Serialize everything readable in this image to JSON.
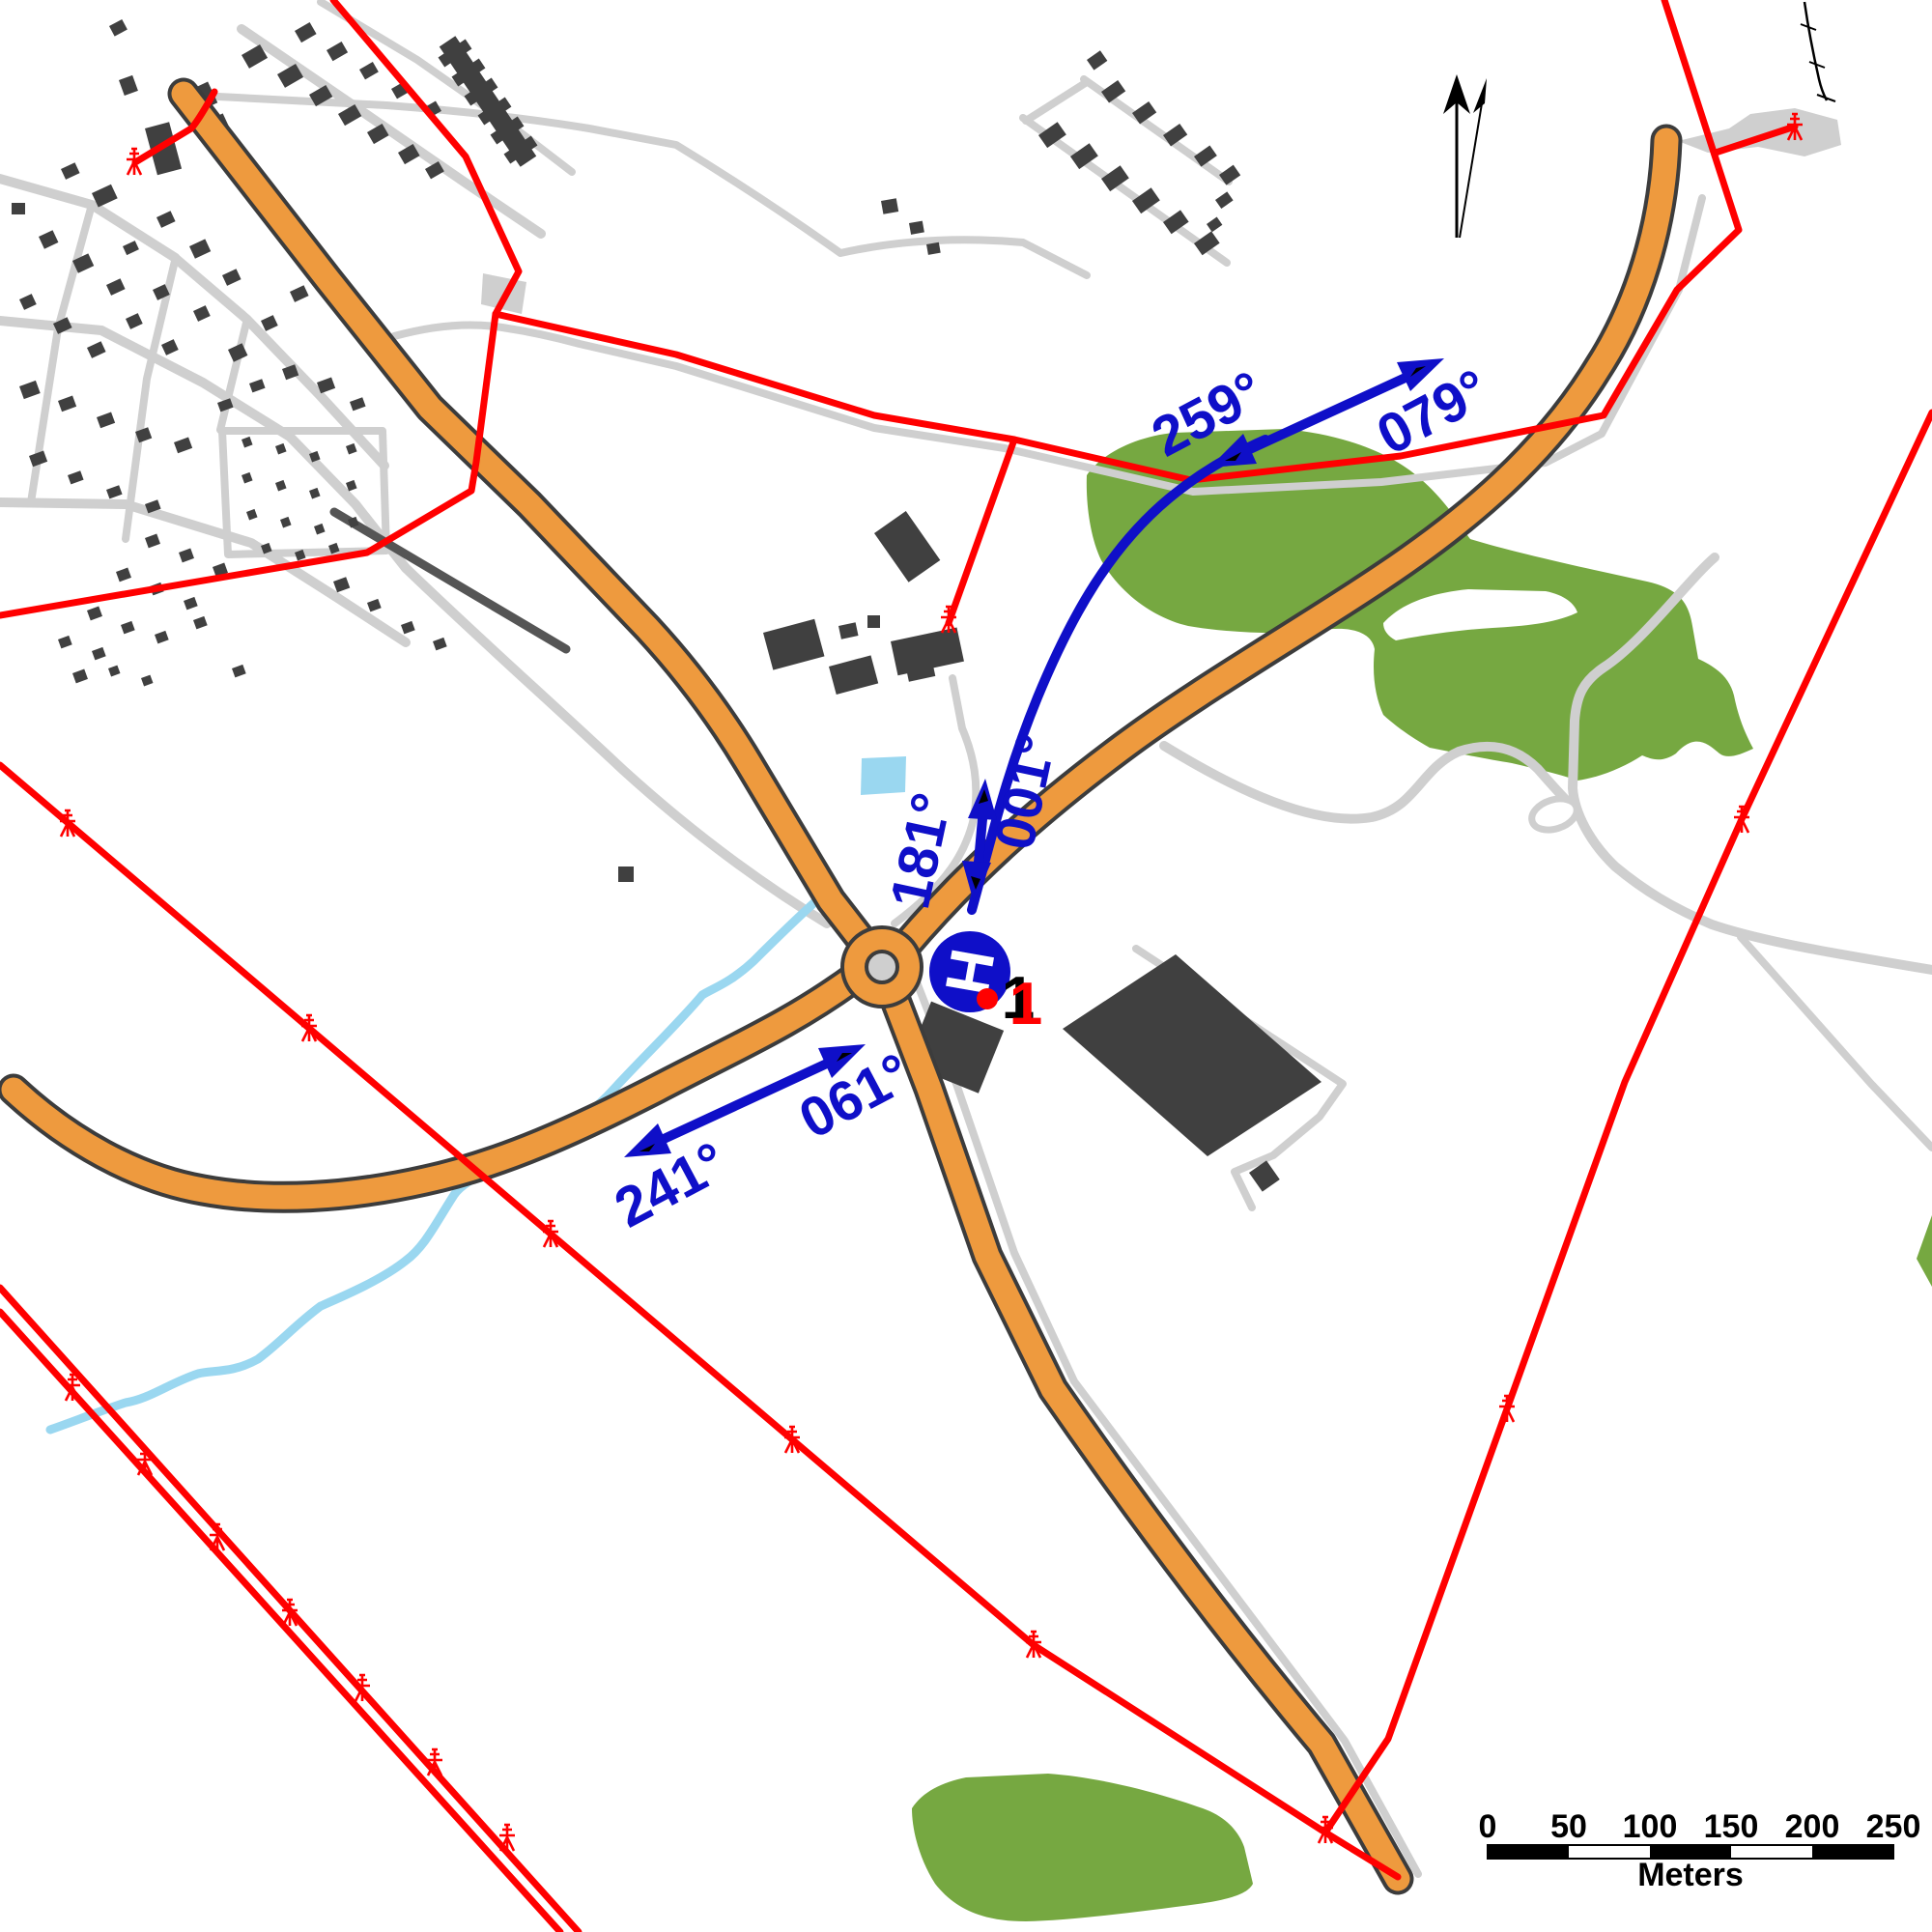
{
  "map": {
    "colors": {
      "orange": "#EE9A3E",
      "casing": "#3C3C3C",
      "street": "#CFCFCF",
      "darkstreet": "#555555",
      "building": "#404040",
      "green": "#76A841",
      "water": "#9AD7F0",
      "red": "#FF0000",
      "blue": "#0F0FC8",
      "black": "#000000"
    },
    "bearing_labels": {
      "arrow_ne": {
        "toward_west": "259°",
        "toward_east": "079°"
      },
      "arrow_site": {
        "south": "181°",
        "north": "001°"
      },
      "arrow_sw": {
        "toward_west": "241°",
        "toward_east": "061°"
      }
    },
    "site_marker": {
      "label": "1",
      "helipad_symbol": "H"
    },
    "scale_bar": {
      "ticks": [
        "0",
        "50",
        "100",
        "150",
        "200",
        "250"
      ],
      "unit": "Meters"
    }
  }
}
